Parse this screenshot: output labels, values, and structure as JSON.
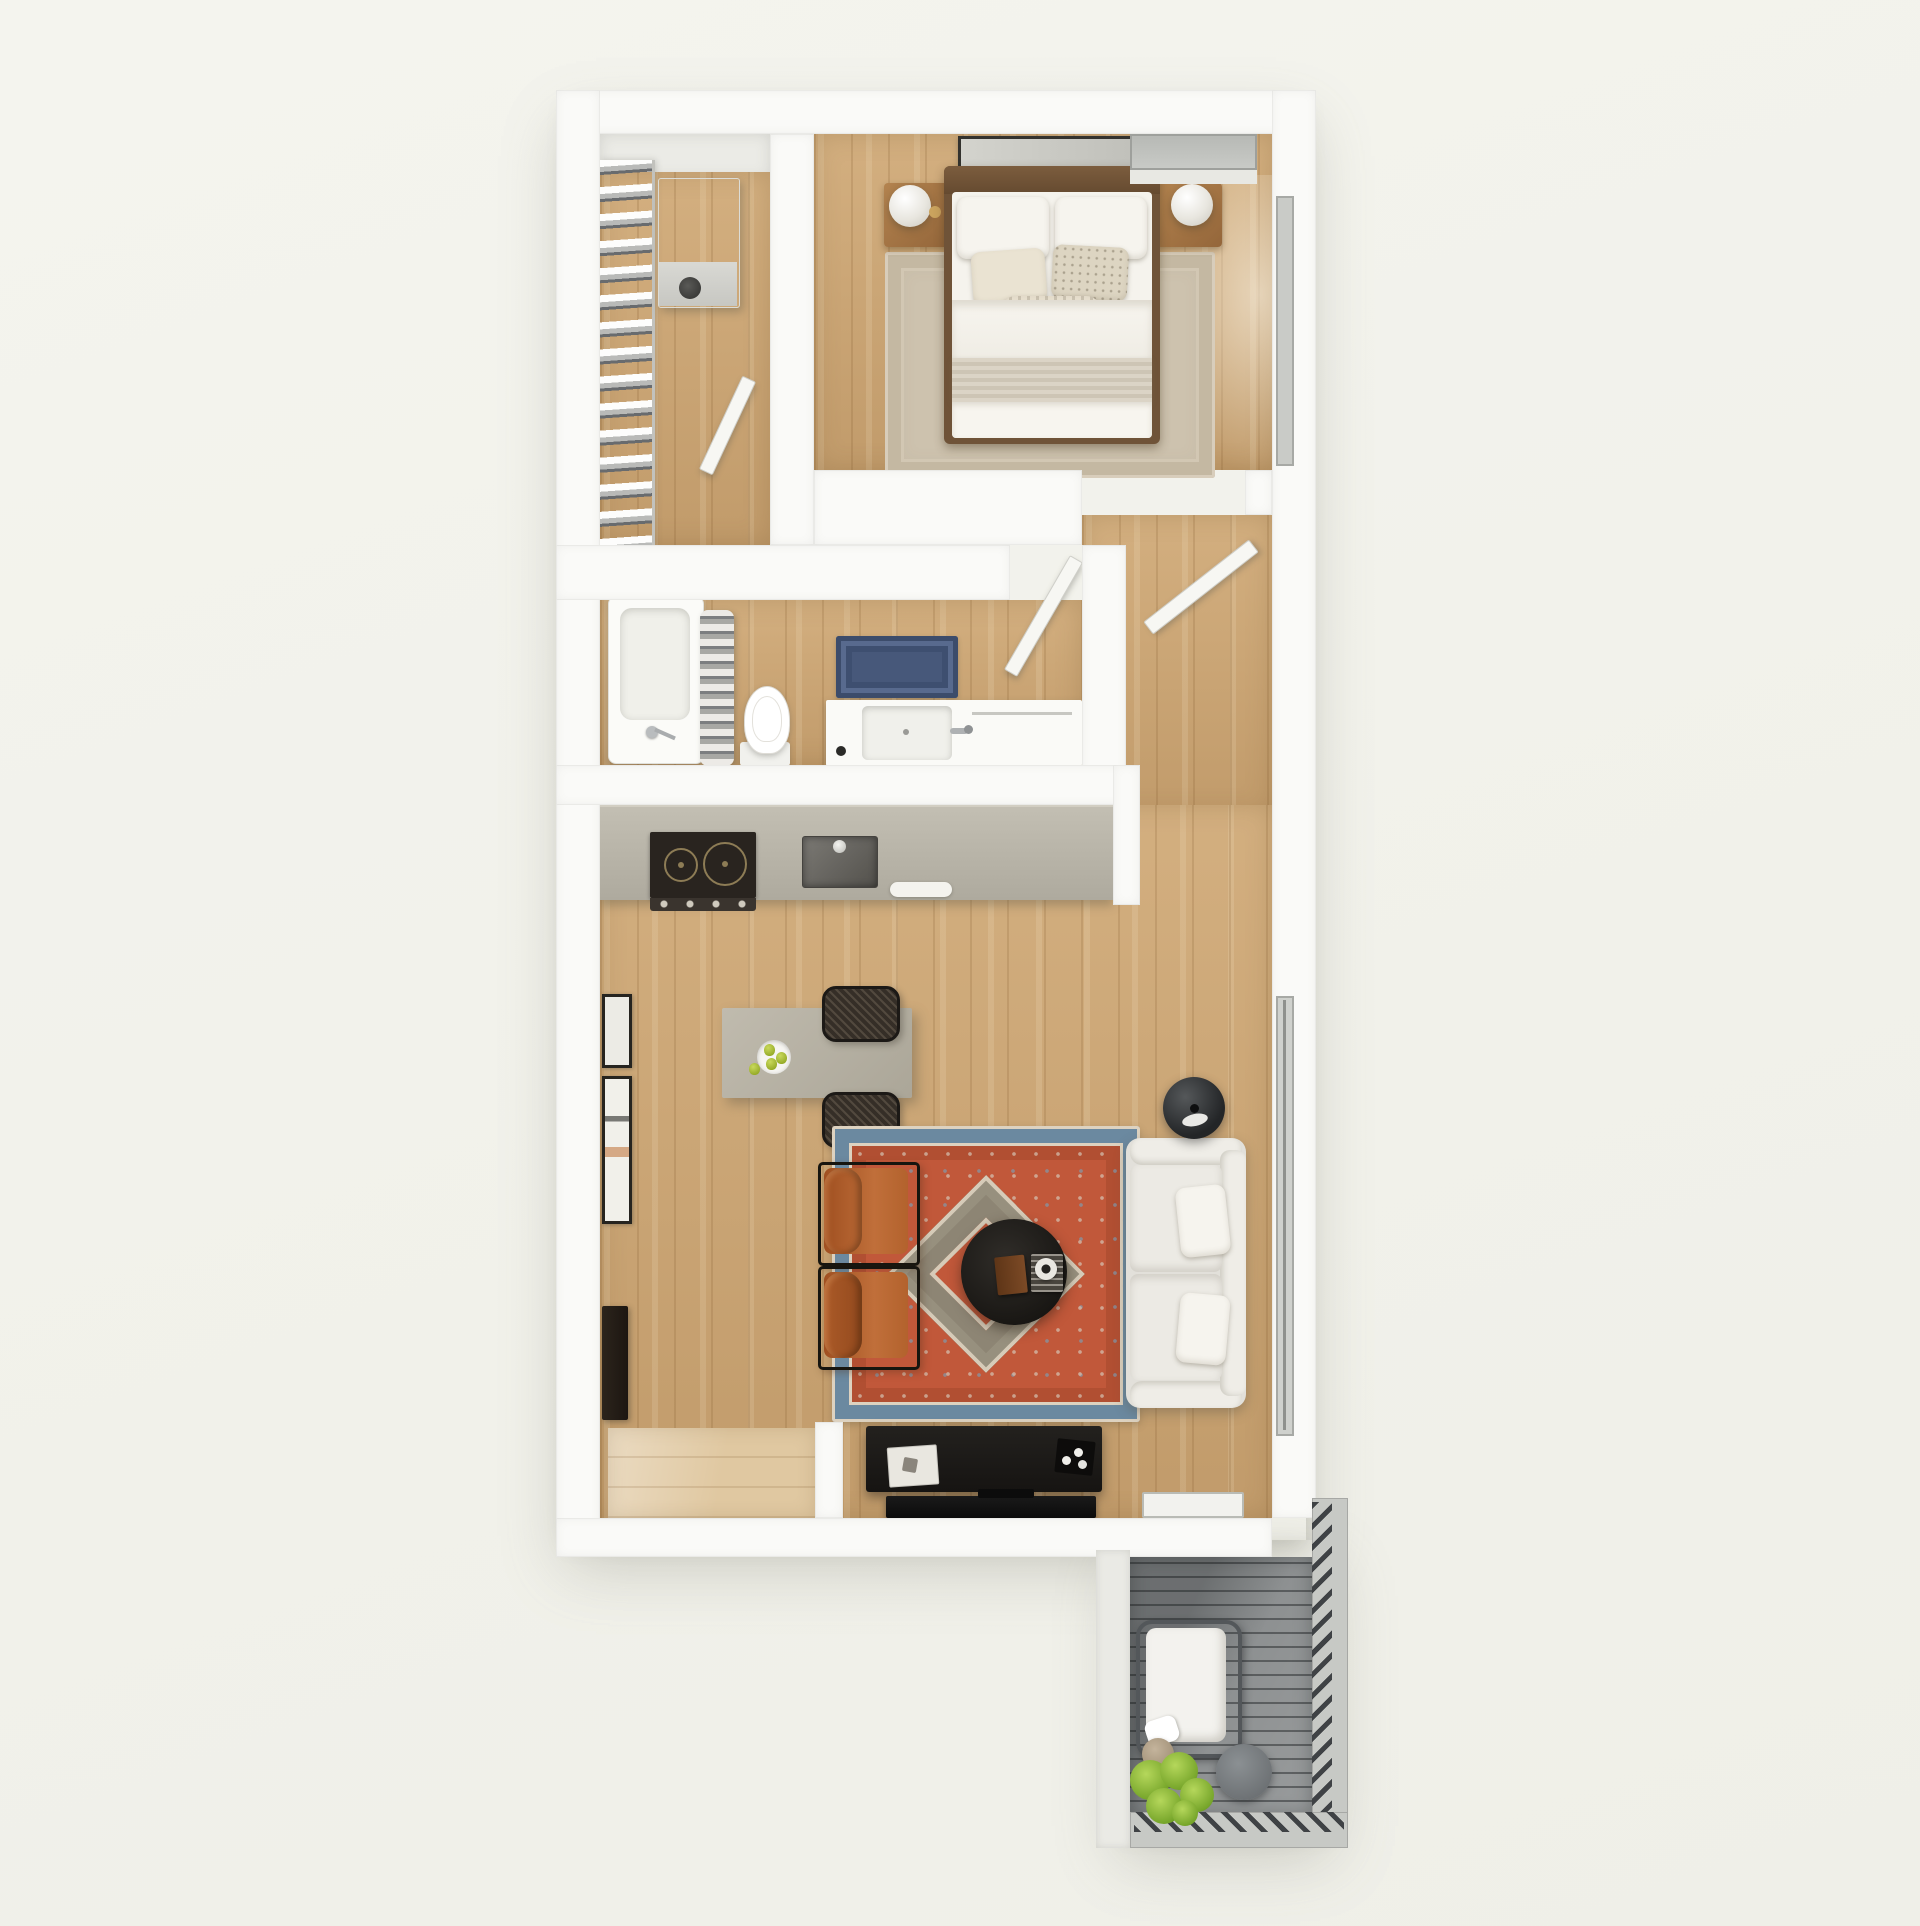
{
  "scene": {
    "type": "3d-floor-plan-render",
    "view": "top-down",
    "description": "One-bedroom apartment floor plan with closet, bedroom, bathroom, kitchen, living-dining area, entry and balcony"
  },
  "colors": {
    "wall": "#fafaf8",
    "wood": "#cda674",
    "wood_light": "#e0c8a1",
    "deck": "#8d9091",
    "rug_red": "#c1583a",
    "rug_blue": "#6b89a0",
    "rug_cream": "#d9cfc0",
    "rug_olive": "#8d8574",
    "bath_rug_blue": "#47587a",
    "leather_orange": "#b5622f",
    "sofa_white": "#e9e7e1",
    "counter_greige": "#b7b3a7",
    "console_black": "#1d1b19",
    "plant_green": "#86b32d"
  },
  "rooms": [
    {
      "id": "closet",
      "label": "walk-in closet",
      "items": [
        "hanging clothes rack",
        "water heater unit",
        "closet door"
      ]
    },
    {
      "id": "bedroom",
      "label": "bedroom",
      "items": [
        "double bed with white bedding",
        "striped throw blanket",
        "left nightstand with sphere lamp",
        "right nightstand with sphere lamp",
        "wall art above headboard",
        "beige bordered area rug",
        "window top wall",
        "window right wall",
        "bedroom door"
      ]
    },
    {
      "id": "bathroom",
      "label": "bathroom",
      "items": [
        "bathtub with faucet",
        "shower curtain",
        "toilet",
        "navy bath rug",
        "vanity with sink",
        "bathroom door"
      ]
    },
    {
      "id": "kitchen",
      "label": "kitchen",
      "items": [
        "countertop run",
        "two-burner cooktop",
        "stainless sink",
        "white dish",
        "island dining table",
        "fruit bowl with pears",
        "two rattan chairs",
        "framed art on wall",
        "tall dark cabinet"
      ]
    },
    {
      "id": "living",
      "label": "living room",
      "items": [
        "persian style rug",
        "two cognac leather chairs",
        "round black coffee table",
        "book and cup on table",
        "white two-seat sofa with pillows",
        "black floor lamp",
        "media console with decor",
        "flat tv",
        "balcony door threshold"
      ]
    },
    {
      "id": "entry",
      "label": "entry",
      "items": [
        "light wood entry floor",
        "partition wall stub"
      ]
    },
    {
      "id": "balcony",
      "label": "balcony",
      "items": [
        "gray plank decking",
        "slatted railing",
        "outdoor lounge chair with white cushion",
        "round side table",
        "potted plant",
        "small planter pot"
      ]
    }
  ]
}
